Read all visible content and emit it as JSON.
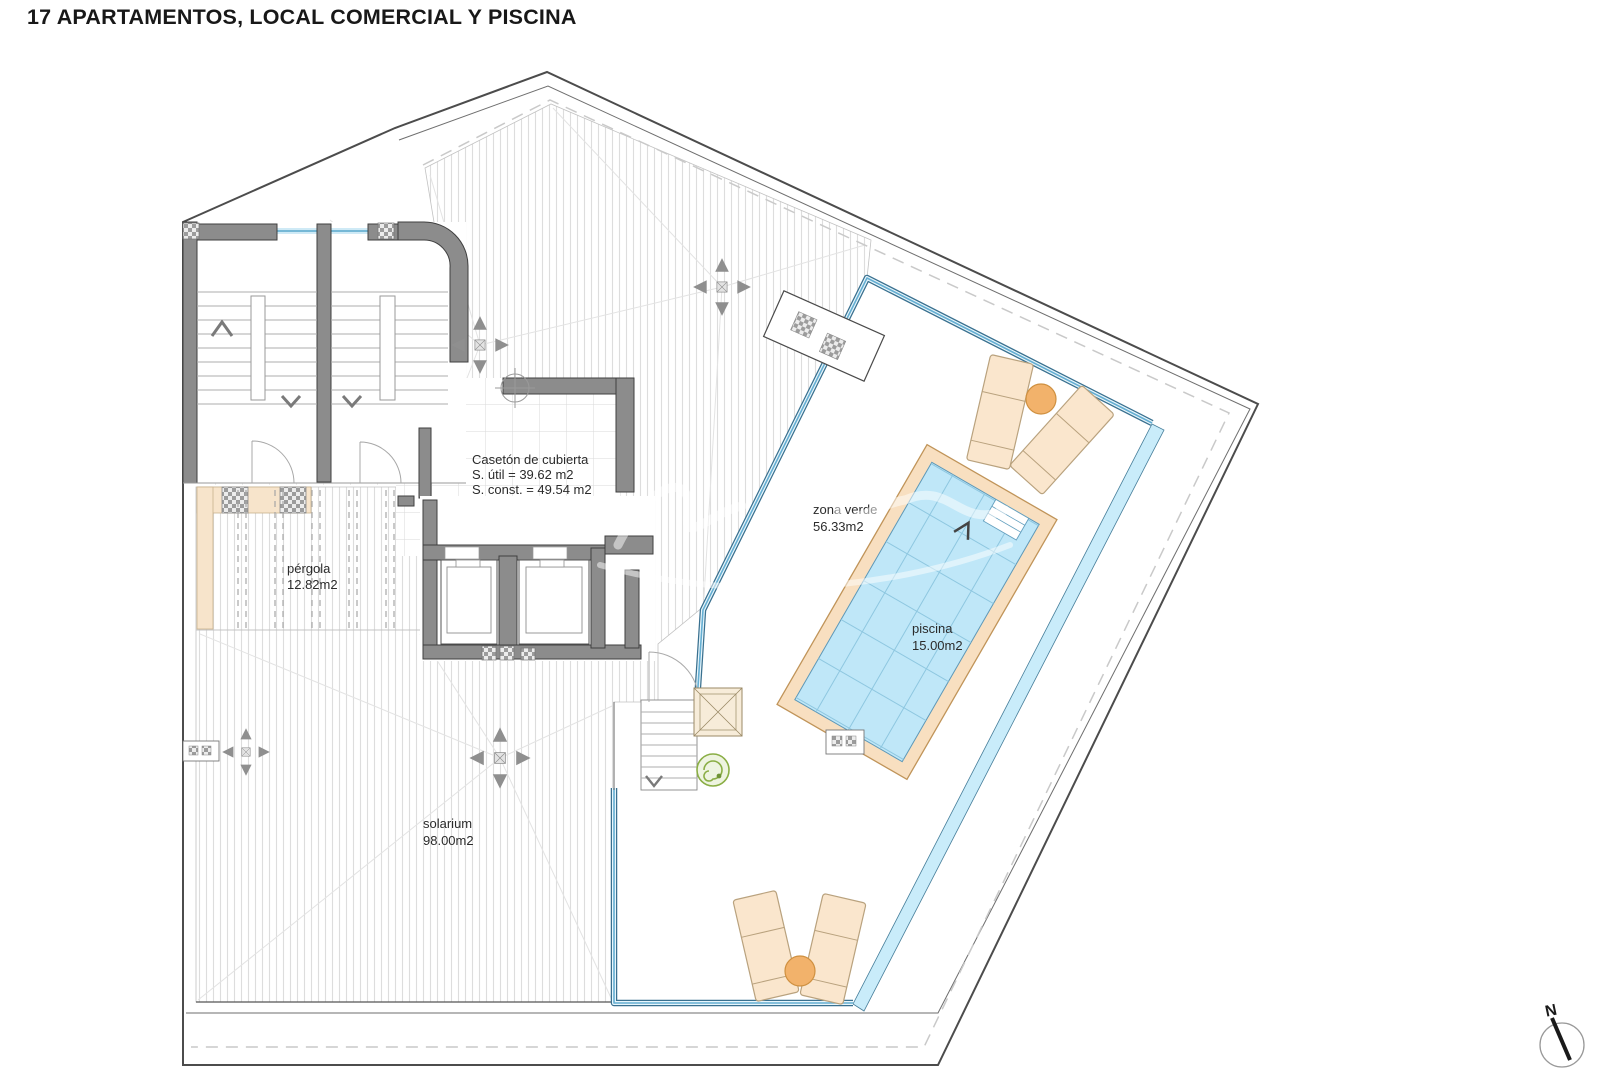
{
  "title": "17 APARTAMENTOS, LOCAL COMERCIAL Y PISCINA",
  "labels": {
    "caseton": {
      "name": "Casetón de cubierta",
      "util": "S. útil = 39.62 m2",
      "const": "S. const. = 49.54 m2"
    },
    "pergola": {
      "name": "pérgola",
      "area": "12.82m2"
    },
    "zona_verde": {
      "name": "zona verde",
      "area": "56.33m2"
    },
    "piscina": {
      "name": "piscina",
      "area": "15.00m2"
    },
    "solarium": {
      "name": "solarium",
      "area": "98.00m2"
    }
  },
  "compass": {
    "label": "N"
  },
  "colors": {
    "wall_gray": "#8c8c8c",
    "glass_blue": "#64aed2",
    "water_blue": "#bfe7f8",
    "pool_deck_tan": "#f8dfc0",
    "lounger_tan": "#fae6cd",
    "table_orange": "#f2b26b",
    "pergola_beige": "#f7e4cb"
  }
}
